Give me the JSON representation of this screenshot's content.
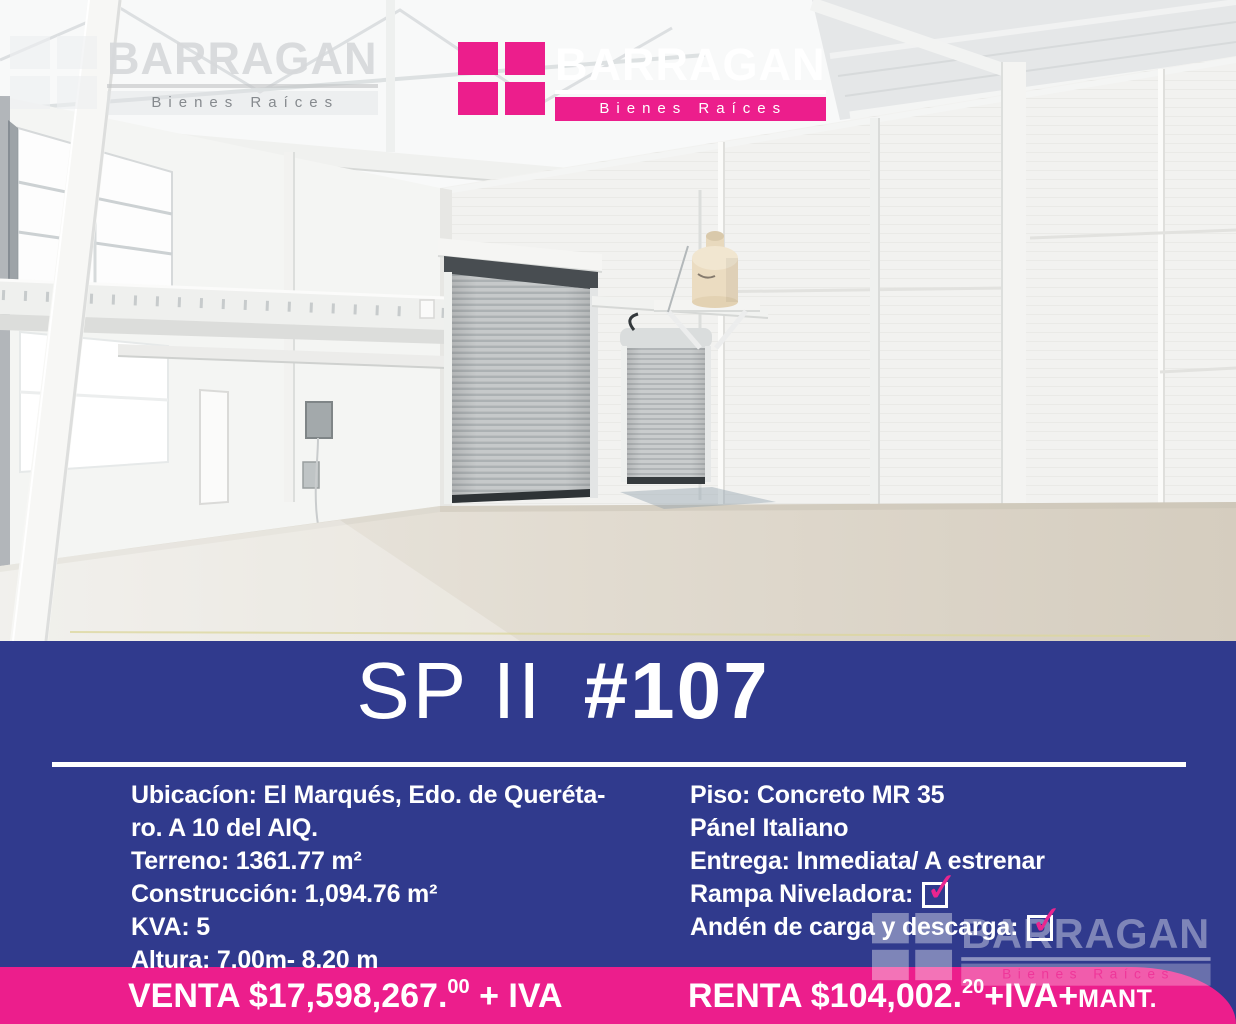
{
  "brand": {
    "name": "BARRAGAN",
    "tagline": "Bienes Raíces",
    "pink": "#ec1e8c",
    "navy": "#303a8d"
  },
  "title": {
    "light": "SP II",
    "bold": "#107"
  },
  "details": {
    "left": [
      "Ubicacíon: El Marqués, Edo. de Queréta-",
      "ro. A 10 del AIQ.",
      "Terreno: 1361.77 m²",
      "Construcción: 1,094.76 m²",
      "KVA: 5",
      "Altura: 7.00m- 8.20 m"
    ],
    "right_plain": [
      "Piso: Concreto MR 35",
      "Pánel Italiano",
      "Entrega: Inmediata/ A estrenar"
    ],
    "right_checks": [
      "Rampa Niveladora:",
      "Andén de carga y descarga:"
    ]
  },
  "pricing": {
    "venta": {
      "label": "VENTA $17,598,267.",
      "sup": "00",
      "tail": " + IVA"
    },
    "renta": {
      "label": "RENTA $104,002.",
      "sup": "20",
      "tail": "+IVA+",
      "small": "MANT."
    }
  },
  "icons": {
    "check": "✓"
  }
}
